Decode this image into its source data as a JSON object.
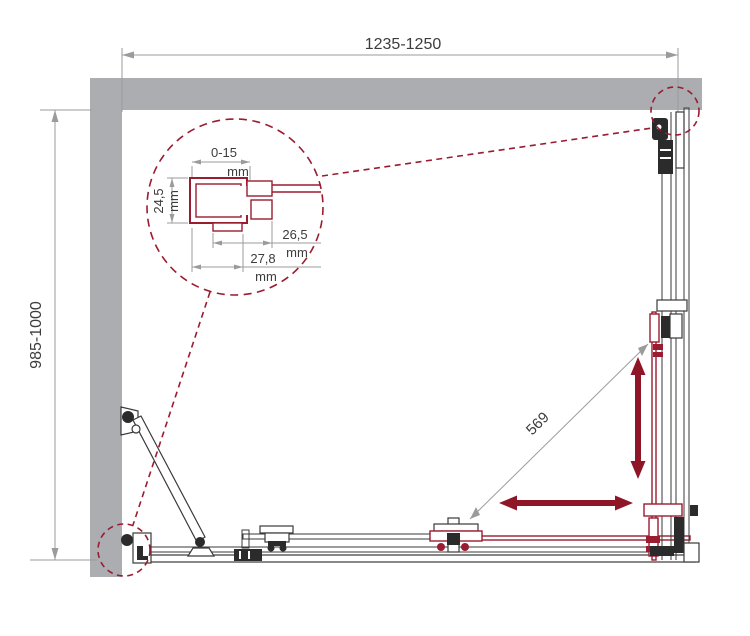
{
  "drawing": {
    "kind": "shower-enclosure-installation-diagram",
    "overall_dimensions": {
      "width": "1235-1250",
      "depth": "985-1000",
      "diagonal_entry": "569"
    },
    "profile_detail": {
      "adjustment_value": "0-15",
      "adjustment_unit": "mm",
      "depth_value": "24,5",
      "depth_unit": "mm",
      "width_inner_value": "26,5",
      "width_inner_unit": "mm",
      "width_outer_value": "27,8",
      "width_outer_unit": "mm"
    },
    "colors": {
      "accent": "#9A1C30",
      "arrow": "#8F1627",
      "wall": "#ABADB0",
      "line": "#3A3A3A",
      "dim-line": "#9B9B9B",
      "dim-text": "#3C3C3C"
    }
  }
}
